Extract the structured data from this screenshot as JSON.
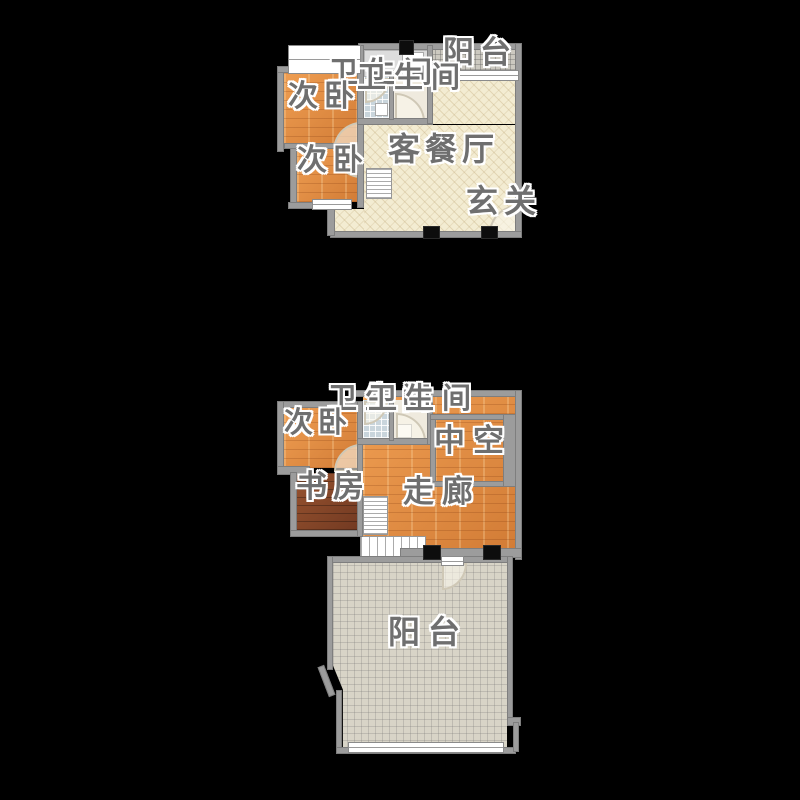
{
  "type": "floor_plan",
  "colors": {
    "background": "#000000",
    "wall": "#9c9c9c",
    "wood_orange": "#e2913f",
    "wood_dark": "#8a4a2e",
    "living_cream": "#f3ecd2",
    "balcony_tile": "#d8d4c7",
    "bath_tile_blue": "#c9d5dc",
    "label_text": "#6f6f6f",
    "column": "#0d0d0d"
  },
  "floor_upper": {
    "labels": {
      "balcony": "阳台",
      "bathroom_a": "卫生间",
      "bathroom_b": "卫生间",
      "bedroom_top": "次卧",
      "bedroom_bottom": "次卧",
      "living_dining": "客餐厅",
      "entry": "玄关"
    }
  },
  "floor_lower": {
    "labels": {
      "bathroom_a": "卫生间",
      "bathroom_b": "卫生间",
      "bedroom": "次卧",
      "study": "书房",
      "void": "中空",
      "corridor": "走廊",
      "balcony": "阳台"
    }
  }
}
